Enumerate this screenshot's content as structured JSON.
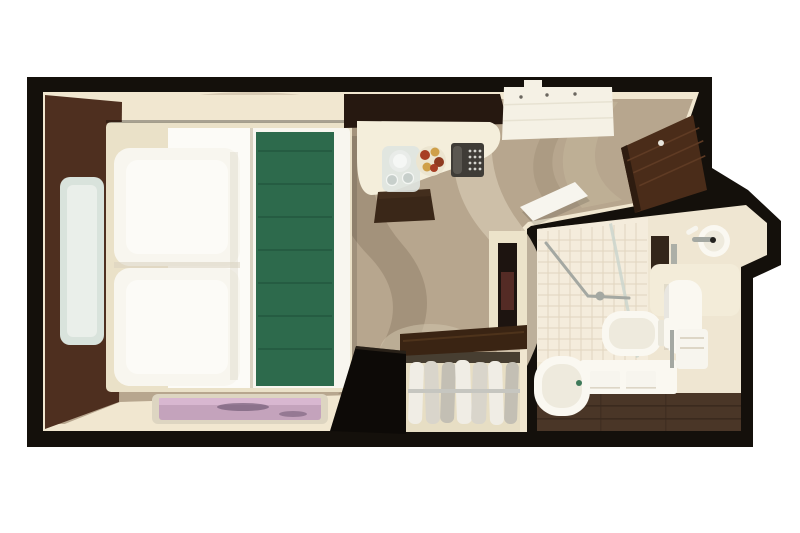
{
  "scene": {
    "label": "Top-down 3D floor plan rendering of a studio cruise-ship stateroom with bed, desk, wardrobe and en-suite bathroom",
    "width": 800,
    "height": 533
  },
  "rooms": {
    "bedroom": "cabin",
    "bathroom": "bathroom"
  },
  "objects": {
    "bed": "bed-with-green-runner",
    "pillows": "two-pillows",
    "headboard_wall": "leather-headboard-wall",
    "light_panel": "backlit-glass-panel",
    "rug": "accent-rug",
    "desk": "desk",
    "ice_bucket": "ice-bucket-with-glasses",
    "fruit_bowl": "fruit-bowl",
    "telephone": "telephone",
    "stool": "stool",
    "ceiling_panel": "ceiling-light-panel",
    "entry_door": "entry-door-open",
    "bathroom_door": "bathroom-door-open",
    "tv": "wall-mounted-tv",
    "wardrobe": "open-wardrobe-with-hanging-clothes",
    "shower": "tiled-shower",
    "bathtub": "bathtub",
    "bath_mats": "two-bath-mats",
    "toilet": "toilet",
    "sink": "washbasin-with-faucet",
    "towel": "hand-towel"
  },
  "colors": {
    "background": "#ffffff",
    "wall": "#14100b",
    "trim": "#f1e7d0",
    "carpet": "#b7a68e",
    "carpet_swirl_light": "#cfc2ab",
    "carpet_swirl_mid": "#c0b097",
    "carpet_swirl_dark": "#9c8b74",
    "headboard": "#4e2f1f",
    "glass_panel": "#d9e3dc",
    "glass_inner": "#ecf1ec",
    "bed_frame": "#eae1c8",
    "bedding_white": "#f8f6ef",
    "bedding_sheet": "#fcfbf7",
    "bedding_shadow": "#d8d1c0",
    "runner": "#2d6a4c",
    "runner_dark": "#1d4c36",
    "rug_border": "#ddd5c1",
    "rug_pink": "#c4a3bc",
    "rug_pink_light": "#dab9d1",
    "rug_art": "#6f5771",
    "cabinet": "#261810",
    "desk": "#f4eedb",
    "stool": "#3a2718",
    "stool_top": "#4a3322",
    "phone": "#3f3c37",
    "phone_handset": "#5a5751",
    "phone_keys": "#d3d3cd",
    "bucket_tray": "#dfe4e0",
    "bucket": "#e9ece9",
    "bucket_inner": "#f5f7f5",
    "glass_cup": "#c7cfcb",
    "bowl": "#ece5d0",
    "fruit_red": "#a83e24",
    "fruit_deep": "#8f3b20",
    "fruit_yellow": "#cfa04a",
    "door_wood": "#4a2c19",
    "door_wood_light": "#5f3b24",
    "door_wood_dark": "#2e1c10",
    "door_handle": "#e8e5dc",
    "ceiling_panel": "#f5f1e5",
    "panel_seam": "#e7e2d2",
    "panel_dot": "#6b675f",
    "tv_niche": "#ece3ca",
    "tv_screen": "#1d1410",
    "tv_glow": "#7a3b33",
    "closet_wood": "#3a2413",
    "closet_wood_light": "#573a20",
    "closet_black": "#0d0a07",
    "closet_black_edge": "#453729",
    "closet_interior": "#e7dec4",
    "closet_shadow": "#352c21",
    "rail": "#c6c6c0",
    "clothes_light": "#f0ede5",
    "clothes_mid": "#d9d5cb",
    "clothes_dark": "#c3bfb4",
    "bath_wall": "#efe6d2",
    "tile": "#f4ecdc",
    "tile_grout": "#ddd1ba",
    "shower_glass": "#c9d4cd",
    "chrome": "#a4a8a2",
    "shower_column": "#33261a",
    "bath_wood": "#4a3627",
    "bath_wood_dark": "#37281d",
    "fixture": "#faf8f1",
    "fixture_inner": "#eeeadd",
    "fixture_hinge": "#e9e6da",
    "counter": "#f3ecd9",
    "towel": "#f7f5ee",
    "towel_fold": "#ddd6c6",
    "soap": "#3f7a5a",
    "knob": "#23221f",
    "shadow": "#000000"
  }
}
